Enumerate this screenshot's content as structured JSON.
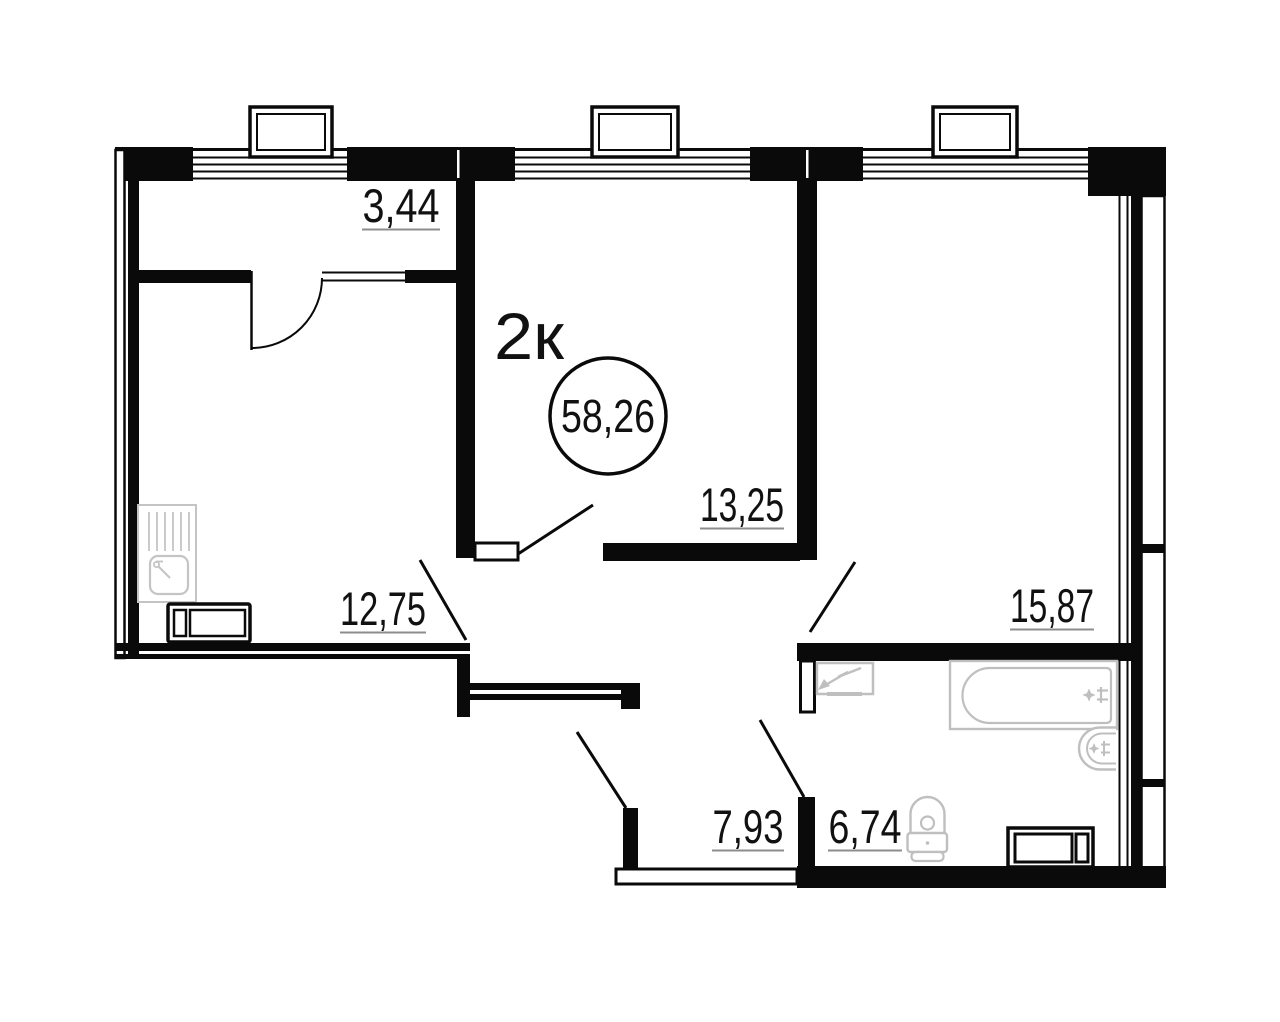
{
  "plan": {
    "apartment_type": "2к",
    "total_area": "58,26",
    "rooms": [
      {
        "name": "loggia",
        "area": "3,44"
      },
      {
        "name": "bedroom",
        "area": "13,25"
      },
      {
        "name": "kitchen",
        "area": "12,75"
      },
      {
        "name": "living-room",
        "area": "15,87"
      },
      {
        "name": "hallway",
        "area": "7,93"
      },
      {
        "name": "bathroom",
        "area": "6,74"
      }
    ],
    "colors": {
      "wall": "#0a0a0a",
      "fixture": "#bfbfbf",
      "underline": "#8c8c8c",
      "background": "#ffffff"
    },
    "icons": {
      "windows": "window-icon",
      "vents": "vent-duct-icon",
      "doors": "door-swing-icon",
      "kitchen_unit": "kitchen-sink-icon",
      "stove": "stove-cabinet-icon",
      "panel": "electrical-panel-icon",
      "tub": "bathtub-icon",
      "basin": "washbasin-icon",
      "wc": "toilet-icon",
      "washer": "washing-machine-icon"
    }
  }
}
